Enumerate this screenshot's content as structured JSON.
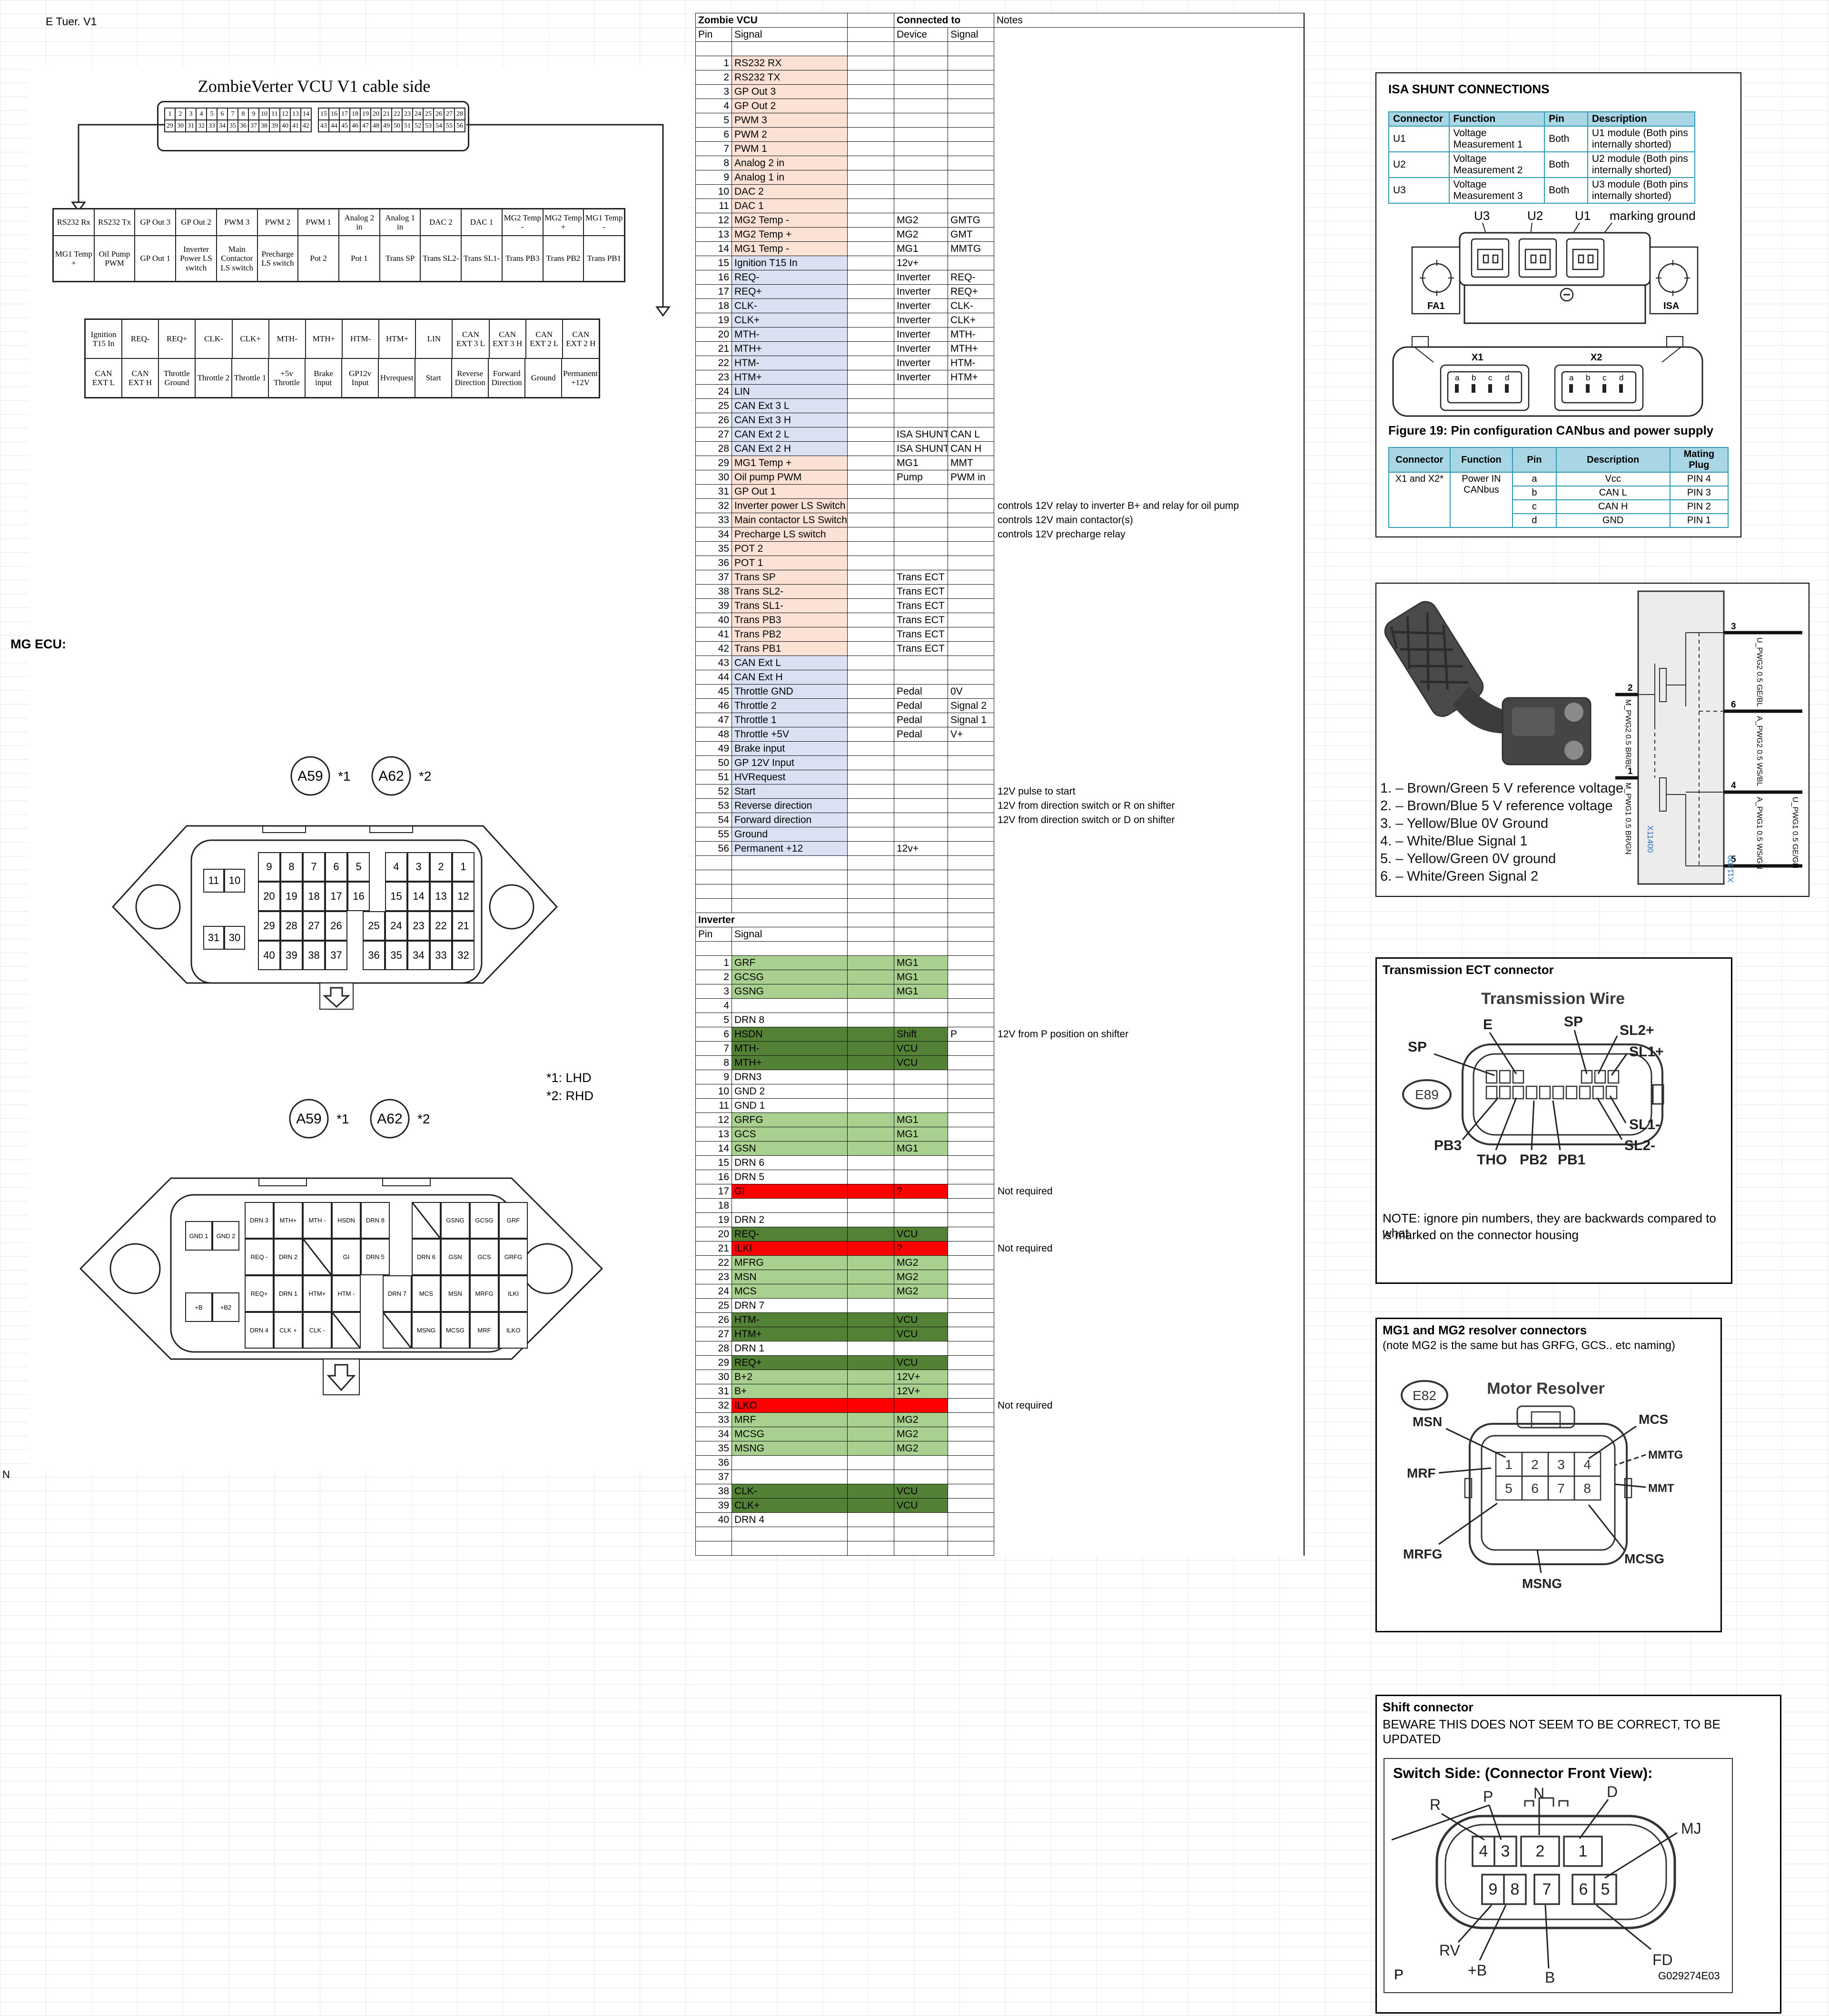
{
  "sheet": {
    "corner_note": "E Tuer. V1",
    "mg_ecu_label": "MG ECU:",
    "n_label": "N",
    "footnote1": "*1: LHD",
    "footnote2": "*2: RHD",
    "a59": "A59",
    "a62": "A62",
    "s1": "*1",
    "s2": "*2"
  },
  "cable": {
    "title": "ZombieVerter VCU V1 cable side",
    "strip": {
      "tl": [
        "1",
        "2",
        "3",
        "4",
        "5",
        "6",
        "7",
        "8",
        "9",
        "10",
        "11",
        "12",
        "13",
        "14"
      ],
      "tr": [
        "15",
        "16",
        "17",
        "18",
        "19",
        "20",
        "21",
        "22",
        "23",
        "24",
        "25",
        "26",
        "27",
        "28"
      ],
      "bl": [
        "29",
        "30",
        "31",
        "32",
        "33",
        "34",
        "35",
        "36",
        "37",
        "38",
        "39",
        "40",
        "41",
        "42"
      ],
      "br": [
        "43",
        "44",
        "45",
        "46",
        "47",
        "48",
        "49",
        "50",
        "51",
        "52",
        "53",
        "54",
        "55",
        "56"
      ]
    },
    "table1": [
      [
        "RS232 Rx",
        "RS232 Tx",
        "GP Out 3",
        "GP Out 2",
        "PWM 3",
        "PWM 2",
        "PWM 1",
        "Analog 2 in",
        "Analog 1 in",
        "DAC 2",
        "DAC 1",
        "MG2 Temp -",
        "MG2 Temp +",
        "MG1 Temp -"
      ],
      [
        "MG1 Temp +",
        "Oil Pump PWM",
        "GP Out 1",
        "Inverter Power LS switch",
        "Main Contactor LS switch",
        "Precharge LS switch",
        "Pot 2",
        "Pot 1",
        "Trans SP",
        "Trans SL2-",
        "Trans SL1-",
        "Trans PB3",
        "Trans PB2",
        "Trans PB1"
      ]
    ],
    "table2": [
      [
        "Ignition T15 In",
        "REQ-",
        "REQ+",
        "CLK-",
        "CLK+",
        "MTH-",
        "MTH+",
        "HTM-",
        "HTM+",
        "LIN",
        "CAN EXT 3 L",
        "CAN EXT 3 H",
        "CAN EXT 2 L",
        "CAN EXT 2 H"
      ],
      [
        "CAN EXT L",
        "CAN EXT H",
        "Throttle Ground",
        "Throttle 2",
        "Throttle 1",
        "+5v Throttle",
        "Brake input",
        "GP12v Input",
        "Hvrequest",
        "Start",
        "Reverse Direction",
        "Forward Direction",
        "Ground",
        "Permanent +12V"
      ]
    ]
  },
  "ecu_top": {
    "small": [
      [
        "11",
        "10"
      ],
      [
        "31",
        "30"
      ]
    ],
    "rows": [
      {
        "l": [
          "9",
          "8",
          "7",
          "6",
          "5"
        ],
        "r": [
          "4",
          "3",
          "2",
          "1"
        ]
      },
      {
        "l": [
          "20",
          "19",
          "18",
          "17",
          "16"
        ],
        "r": [
          "15",
          "14",
          "13",
          "12"
        ]
      },
      {
        "l": [
          "29",
          "28",
          "27",
          "26"
        ],
        "r": [
          "25",
          "24",
          "23",
          "22",
          "21"
        ]
      },
      {
        "l": [
          "40",
          "39",
          "38",
          "37"
        ],
        "r": [
          "36",
          "35",
          "34",
          "33",
          "32"
        ]
      }
    ]
  },
  "ecu_bottom": {
    "small": [
      [
        "GND 1",
        "GND 2"
      ],
      [
        "+B",
        "+B2"
      ]
    ],
    "rows": [
      {
        "l": [
          "DRN 3",
          "MTH+",
          "MTH -",
          "HSDN",
          "DRN 8"
        ],
        "r": [
          "/",
          "GSNG",
          "GCSG",
          "GRF"
        ]
      },
      {
        "l": [
          "REQ -",
          "DRN 2",
          "/",
          "GI",
          "DRN 5"
        ],
        "r": [
          "DRN 6",
          "GSN",
          "GCS",
          "GRFG"
        ]
      },
      {
        "l": [
          "REQ+",
          "DRN 1",
          "HTM+",
          "HTM -"
        ],
        "r": [
          "DRN 7",
          "MCS",
          "MSN",
          "MRFG",
          "ILKI"
        ]
      },
      {
        "l": [
          "DRN 4",
          "CLK +",
          "CLK -",
          "/"
        ],
        "r": [
          "/",
          "MSNG",
          "MCSG",
          "MRF",
          "ILKO"
        ]
      }
    ]
  },
  "vcu": {
    "title": "Zombie VCU",
    "connected": "Connected to",
    "notes": "Notes",
    "pin": "Pin",
    "signal": "Signal",
    "device": "Device",
    "signal2": "Signal",
    "rows": [
      [
        "1",
        "RS232 RX",
        "",
        "",
        "",
        "p"
      ],
      [
        "2",
        "RS232 TX",
        "",
        "",
        "",
        "p"
      ],
      [
        "3",
        "GP Out 3",
        "",
        "",
        "",
        "p"
      ],
      [
        "4",
        "GP Out 2",
        "",
        "",
        "",
        "p"
      ],
      [
        "5",
        "PWM 3",
        "",
        "",
        "",
        "p"
      ],
      [
        "6",
        "PWM 2",
        "",
        "",
        "",
        "p"
      ],
      [
        "7",
        "PWM 1",
        "",
        "",
        "",
        "p"
      ],
      [
        "8",
        "Analog 2 in",
        "",
        "",
        "",
        "p"
      ],
      [
        "9",
        "Analog 1 in",
        "",
        "",
        "",
        "p"
      ],
      [
        "10",
        "DAC 2",
        "",
        "",
        "",
        "p"
      ],
      [
        "11",
        "DAC 1",
        "",
        "",
        "",
        "p"
      ],
      [
        "12",
        "MG2 Temp -",
        "MG2",
        "GMTG",
        "",
        "p"
      ],
      [
        "13",
        "MG2 Temp +",
        "MG2",
        "GMT",
        "",
        "p"
      ],
      [
        "14",
        "MG1 Temp -",
        "MG1",
        "MMTG",
        "",
        "p"
      ],
      [
        "15",
        "Ignition T15 In",
        "12v+",
        "",
        "",
        "b"
      ],
      [
        "16",
        "REQ-",
        "Inverter",
        "REQ-",
        "",
        "b"
      ],
      [
        "17",
        "REQ+",
        "Inverter",
        "REQ+",
        "",
        "b"
      ],
      [
        "18",
        "CLK-",
        "Inverter",
        "CLK-",
        "",
        "b"
      ],
      [
        "19",
        "CLK+",
        "Inverter",
        "CLK+",
        "",
        "b"
      ],
      [
        "20",
        "MTH-",
        "Inverter",
        "MTH-",
        "",
        "b"
      ],
      [
        "21",
        "MTH+",
        "Inverter",
        "MTH+",
        "",
        "b"
      ],
      [
        "22",
        "HTM-",
        "Inverter",
        "HTM-",
        "",
        "b"
      ],
      [
        "23",
        "HTM+",
        "Inverter",
        "HTM+",
        "",
        "b"
      ],
      [
        "24",
        "LIN",
        "",
        "",
        "",
        "b"
      ],
      [
        "25",
        "CAN Ext 3 L",
        "",
        "",
        "",
        "b"
      ],
      [
        "26",
        "CAN Ext 3 H",
        "",
        "",
        "",
        "b"
      ],
      [
        "27",
        "CAN Ext 2 L",
        "ISA SHUNT",
        "CAN L",
        "",
        "b"
      ],
      [
        "28",
        "CAN Ext 2 H",
        "ISA SHUNT",
        "CAN H",
        "",
        "b"
      ],
      [
        "29",
        "MG1 Temp +",
        "MG1",
        "MMT",
        "",
        "p"
      ],
      [
        "30",
        "Oil pump PWM",
        "Pump",
        "PWM in",
        "",
        "p"
      ],
      [
        "31",
        "GP Out 1",
        "",
        "",
        "",
        "p"
      ],
      [
        "32",
        "Inverter power LS Switch",
        "",
        "",
        "controls 12V relay to inverter B+ and relay for oil pump",
        "p"
      ],
      [
        "33",
        "Main contactor LS Switch",
        "",
        "",
        "controls 12V main contactor(s)",
        "p"
      ],
      [
        "34",
        "Precharge LS switch",
        "",
        "",
        "controls 12V precharge relay",
        "p"
      ],
      [
        "35",
        "POT 2",
        "",
        "",
        "",
        "p"
      ],
      [
        "36",
        "POT 1",
        "",
        "",
        "",
        "p"
      ],
      [
        "37",
        "Trans SP",
        "Trans ECT",
        "",
        "",
        "p"
      ],
      [
        "38",
        "Trans SL2-",
        "Trans ECT",
        "",
        "",
        "p"
      ],
      [
        "39",
        "Trans SL1-",
        "Trans ECT",
        "",
        "",
        "p"
      ],
      [
        "40",
        "Trans PB3",
        "Trans ECT",
        "",
        "",
        "p"
      ],
      [
        "41",
        "Trans PB2",
        "Trans ECT",
        "",
        "",
        "p"
      ],
      [
        "42",
        "Trans PB1",
        "Trans ECT",
        "",
        "",
        "p"
      ],
      [
        "43",
        "CAN Ext L",
        "",
        "",
        "",
        "b"
      ],
      [
        "44",
        "CAN Ext H",
        "",
        "",
        "",
        "b"
      ],
      [
        "45",
        "Throttle GND",
        "Pedal",
        "0V",
        "",
        "b"
      ],
      [
        "46",
        "Throttle 2",
        "Pedal",
        "Signal 2",
        "",
        "b"
      ],
      [
        "47",
        "Throttle 1",
        "Pedal",
        "Signal 1",
        "",
        "b"
      ],
      [
        "48",
        "Throttle +5V",
        "Pedal",
        "V+",
        "",
        "b"
      ],
      [
        "49",
        "Brake input",
        "",
        "",
        "",
        "b"
      ],
      [
        "50",
        "GP 12V Input",
        "",
        "",
        "",
        "b"
      ],
      [
        "51",
        "HVRequest",
        "",
        "",
        "",
        "b"
      ],
      [
        "52",
        "Start",
        "",
        "",
        "12V pulse to start",
        "b"
      ],
      [
        "53",
        "Reverse direction",
        "",
        "",
        "12V from direction switch or R on shifter",
        "b"
      ],
      [
        "54",
        "Forward direction",
        "",
        "",
        "12V from direction switch or D on shifter",
        "b"
      ],
      [
        "55",
        "Ground",
        "",
        "",
        "",
        "b"
      ],
      [
        "56",
        "Permanent +12",
        "12v+",
        "",
        "",
        "b"
      ]
    ]
  },
  "inverter": {
    "title": "Inverter",
    "pin": "Pin",
    "signal": "Signal",
    "rows": [
      [
        "1",
        "GRF",
        "MG1",
        "",
        "",
        "lg"
      ],
      [
        "2",
        "GCSG",
        "MG1",
        "",
        "",
        "lg"
      ],
      [
        "3",
        "GSNG",
        "MG1",
        "",
        "",
        "lg"
      ],
      [
        "4",
        "",
        "",
        "",
        "",
        ""
      ],
      [
        "5",
        "DRN 8",
        "",
        "",
        "",
        ""
      ],
      [
        "6",
        "HSDN",
        "Shift",
        "P",
        "12V from P position on shifter",
        "dg"
      ],
      [
        "7",
        "MTH-",
        "VCU",
        "",
        "",
        "dg"
      ],
      [
        "8",
        "MTH+",
        "VCU",
        "",
        "",
        "dg"
      ],
      [
        "9",
        "DRN3",
        "",
        "",
        "",
        ""
      ],
      [
        "10",
        "GND 2",
        "",
        "",
        "",
        ""
      ],
      [
        "11",
        "GND 1",
        "",
        "",
        "",
        ""
      ],
      [
        "12",
        "GRFG",
        "MG1",
        "",
        "",
        "lg"
      ],
      [
        "13",
        "GCS",
        "MG1",
        "",
        "",
        "lg"
      ],
      [
        "14",
        "GSN",
        "MG1",
        "",
        "",
        "lg"
      ],
      [
        "15",
        "DRN 6",
        "",
        "",
        "",
        ""
      ],
      [
        "16",
        "DRN 5",
        "",
        "",
        "",
        ""
      ],
      [
        "17",
        "GI",
        "?",
        "",
        "Not required",
        "r"
      ],
      [
        "18",
        "",
        "",
        "",
        "",
        ""
      ],
      [
        "19",
        "DRN 2",
        "",
        "",
        "",
        ""
      ],
      [
        "20",
        "REQ-",
        "VCU",
        "",
        "",
        "dg"
      ],
      [
        "21",
        "ILKI",
        "?",
        "",
        "Not required",
        "r"
      ],
      [
        "22",
        "MFRG",
        "MG2",
        "",
        "",
        "lg"
      ],
      [
        "23",
        "MSN",
        "MG2",
        "",
        "",
        "lg"
      ],
      [
        "24",
        "MCS",
        "MG2",
        "",
        "",
        "lg"
      ],
      [
        "25",
        "DRN 7",
        "",
        "",
        "",
        ""
      ],
      [
        "26",
        "HTM-",
        "VCU",
        "",
        "",
        "dg"
      ],
      [
        "27",
        "HTM+",
        "VCU",
        "",
        "",
        "dg"
      ],
      [
        "28",
        "DRN 1",
        "",
        "",
        "",
        ""
      ],
      [
        "29",
        "REQ+",
        "VCU",
        "",
        "",
        "dg"
      ],
      [
        "30",
        "B+2",
        "12V+",
        "",
        "",
        "lg"
      ],
      [
        "31",
        "B+",
        "12V+",
        "",
        "",
        "lg"
      ],
      [
        "32",
        "ILKO",
        "",
        "",
        "Not required",
        "r"
      ],
      [
        "33",
        "MRF",
        "MG2",
        "",
        "",
        "lg"
      ],
      [
        "34",
        "MCSG",
        "MG2",
        "",
        "",
        "lg"
      ],
      [
        "35",
        "MSNG",
        "MG2",
        "",
        "",
        "lg"
      ],
      [
        "36",
        "",
        "",
        "",
        "",
        ""
      ],
      [
        "37",
        "",
        "",
        "",
        "",
        ""
      ],
      [
        "38",
        "CLK-",
        "VCU",
        "",
        "",
        "dg"
      ],
      [
        "39",
        "CLK+",
        "VCU",
        "",
        "",
        "dg"
      ],
      [
        "40",
        "DRN 4",
        "",
        "",
        "",
        ""
      ]
    ]
  },
  "isa": {
    "title": "ISA SHUNT CONNECTIONS",
    "table": {
      "headers": [
        "Connector",
        "Function",
        "Pin",
        "Description"
      ],
      "rows": [
        [
          "U1",
          "Voltage Measurement 1",
          "Both",
          "U1 module (Both pins internally shorted)"
        ],
        [
          "U2",
          "Voltage Measurement 2",
          "Both",
          "U2 module (Both pins internally shorted)"
        ],
        [
          "U3",
          "Voltage Measurement 3",
          "Both",
          "U3 module (Both pins internally shorted)"
        ]
      ]
    },
    "shunt": {
      "u3": "U3",
      "u2": "U2",
      "u1": "U1",
      "ground": "marking ground",
      "fa1": "FA1",
      "isa": "ISA"
    },
    "fig_caption": "Figure 19: Pin configuration CANbus and power supply",
    "x1": "X1",
    "x2": "X2",
    "abcd": [
      "a",
      "b",
      "c",
      "d"
    ],
    "can": {
      "headers": [
        "Connector",
        "Function",
        "Pin",
        "Description",
        "Mating Plug"
      ],
      "connector": "X1 and X2*",
      "function": "Power IN CANbus",
      "rows": [
        [
          "a",
          "Vcc",
          "PIN 4"
        ],
        [
          "b",
          "CAN L",
          "PIN 3"
        ],
        [
          "c",
          "CAN H",
          "PIN 2"
        ],
        [
          "d",
          "GND",
          "PIN 1"
        ]
      ]
    }
  },
  "pedal": {
    "wires": [
      "1. – Brown/Green 5 V reference voltage",
      "2. – Brown/Blue 5 V reference voltage",
      "3. – Yellow/Blue 0V Ground",
      "4. – White/Blue Signal 1",
      "5. – Yellow/Green 0V ground",
      "6. – White/Green Signal 2"
    ],
    "right_pins": [
      {
        "n": "3",
        "label": "U_PWG2 0.5 GE/BL"
      },
      {
        "n": "6",
        "label": "A_PWG2 0.5 WS/BL"
      },
      {
        "n": "4",
        "label": "A_PWG1 0.5 WS/GN"
      },
      {
        "n": "5",
        "label": "U_PWG1 0.5 GE/GN"
      }
    ],
    "left_pins": [
      {
        "n": "2",
        "label": "M_PWG2 0.5 BR/BL"
      },
      {
        "n": "1",
        "label": "M_PWG1 0.5 BR/GN"
      }
    ],
    "x11400": "X11400"
  },
  "trans": {
    "title": "Transmission ECT connector",
    "fig_title": "Transmission Wire",
    "oval": "E89",
    "labels": {
      "sp_left": "SP",
      "e": "E",
      "sp_top": "SP",
      "sl2p": "SL2+",
      "sl1p": "SL1+",
      "sl1m": "SL1-",
      "sl2m": "SL2-",
      "pb3": "PB3",
      "tho": "THO",
      "pb2": "PB2",
      "pb1": "PB1"
    },
    "note1": "NOTE: ignore pin numbers, they are backwards compared to what",
    "note2": "is marked on the connector housing"
  },
  "resolver": {
    "title": "MG1 and MG2 resolver connectors",
    "subtitle": "(note MG2 is the same but has GRFG, GCS.. etc naming)",
    "oval": "E82",
    "fig_title": "Motor Resolver",
    "pins": [
      "1",
      "2",
      "3",
      "4",
      "5",
      "6",
      "7",
      "8"
    ],
    "labels": {
      "msn": "MSN",
      "mcs": "MCS",
      "mmtg": "MMTG",
      "mmt": "MMT",
      "mrf": "MRF",
      "mrfg": "MRFG",
      "msng": "MSNG",
      "mcsg": "MCSG"
    }
  },
  "shift": {
    "title": "Shift connector",
    "warning": "BEWARE THIS DOES NOT SEEM TO BE CORRECT, TO BE UPDATED",
    "fig_title": "Switch Side: (Connector Front View):",
    "labels": {
      "r": "R",
      "p": "P",
      "n": "N",
      "d": "D",
      "mj": "MJ",
      "rv": "RV",
      "pb": "+B",
      "b": "B",
      "fd": "FD"
    },
    "corner": "P",
    "code": "G029274E03",
    "pins_top": [
      "4",
      "3",
      "2",
      "1"
    ],
    "pins_bottom": [
      "9",
      "8",
      "7",
      "6",
      "5"
    ]
  },
  "colors": {
    "peach": "#FBE2D5",
    "blue": "#D9E1F2",
    "lightgreen": "#A9D08E",
    "darkgreen": "#538135",
    "red": "#FF0000",
    "cyan_header": "#A9D6E5",
    "cyan_border": "#2E9BB5"
  }
}
